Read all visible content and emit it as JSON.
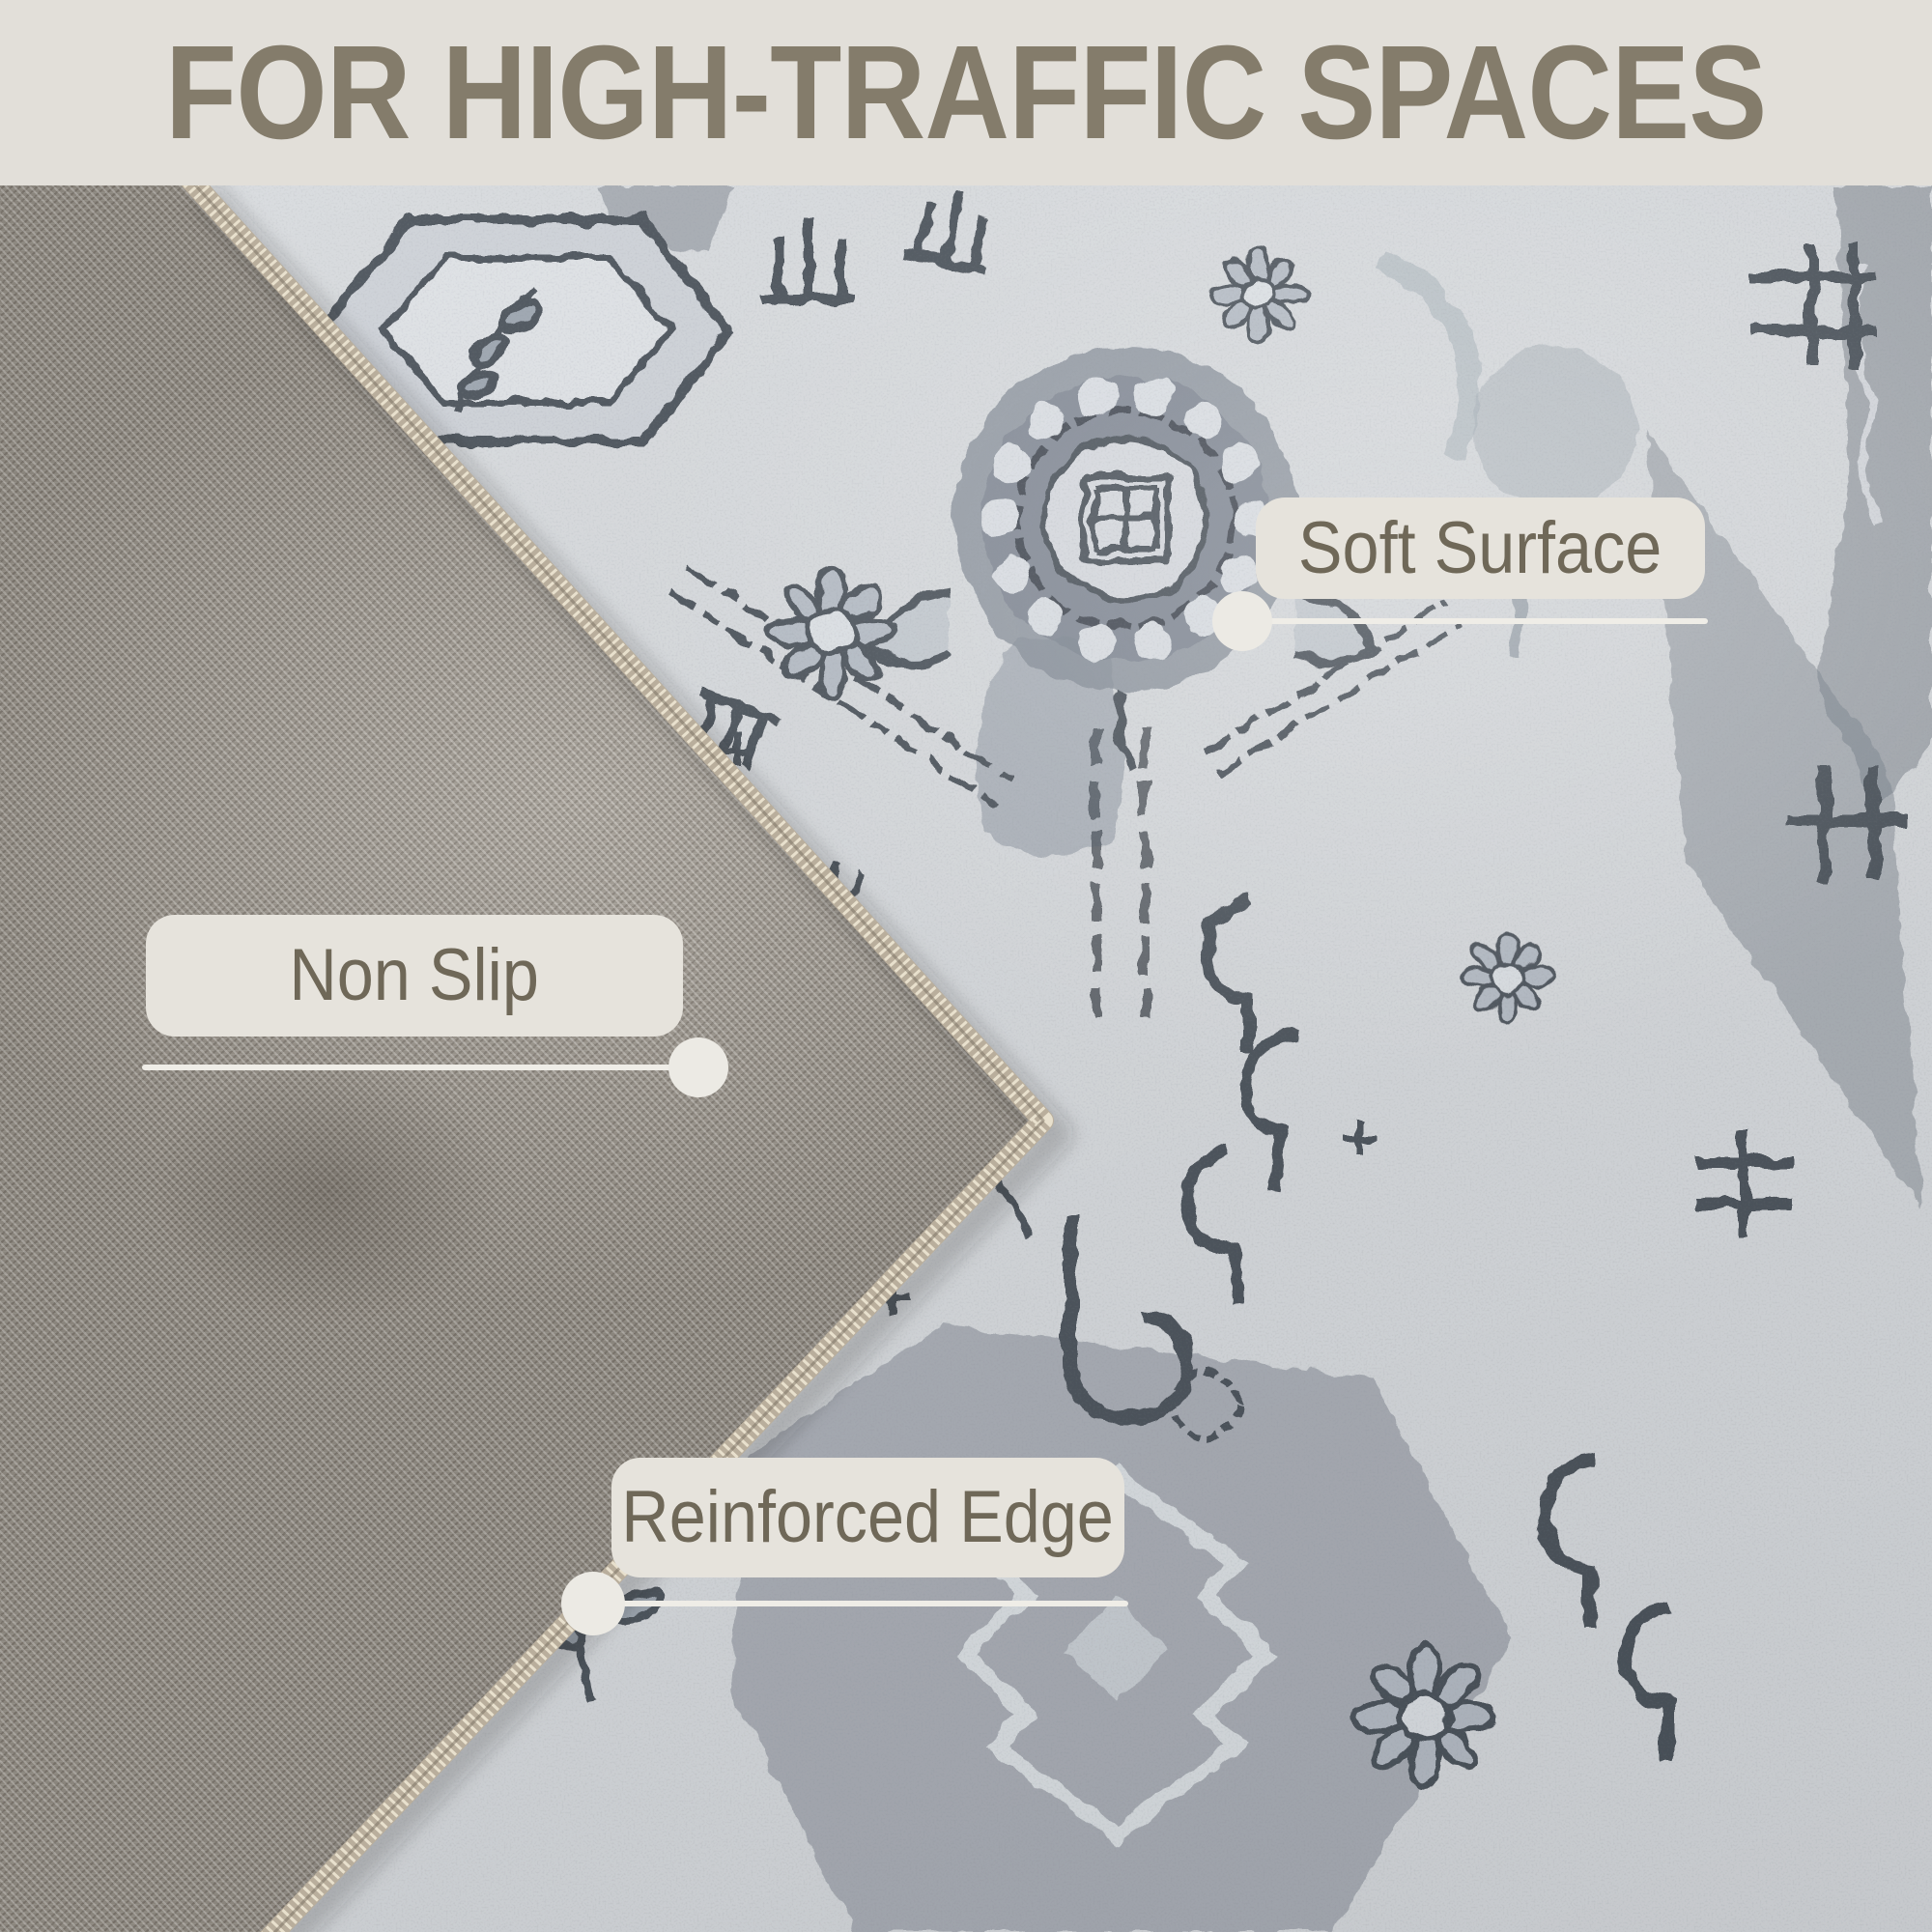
{
  "banner": {
    "title": "FOR HIGH-TRAFFIC SPACES"
  },
  "callouts": [
    {
      "id": "soft-surface",
      "label": "Soft Surface"
    },
    {
      "id": "non-slip",
      "label": "Non Slip"
    },
    {
      "id": "reinforced-edge",
      "label": "Reinforced Edge"
    }
  ],
  "colors": {
    "banner_bg": "#e2dfd9",
    "banner_text": "#847c6b",
    "label_bg": "#e6e3dc",
    "label_text": "#6f6858",
    "leader": "#efede7",
    "rug_base": "#d8dbde",
    "motif_dark": "#3e444d",
    "motif_mid": "#8f98a2",
    "backing": "#9a948b",
    "seam_thread": "#cfc5b2"
  }
}
